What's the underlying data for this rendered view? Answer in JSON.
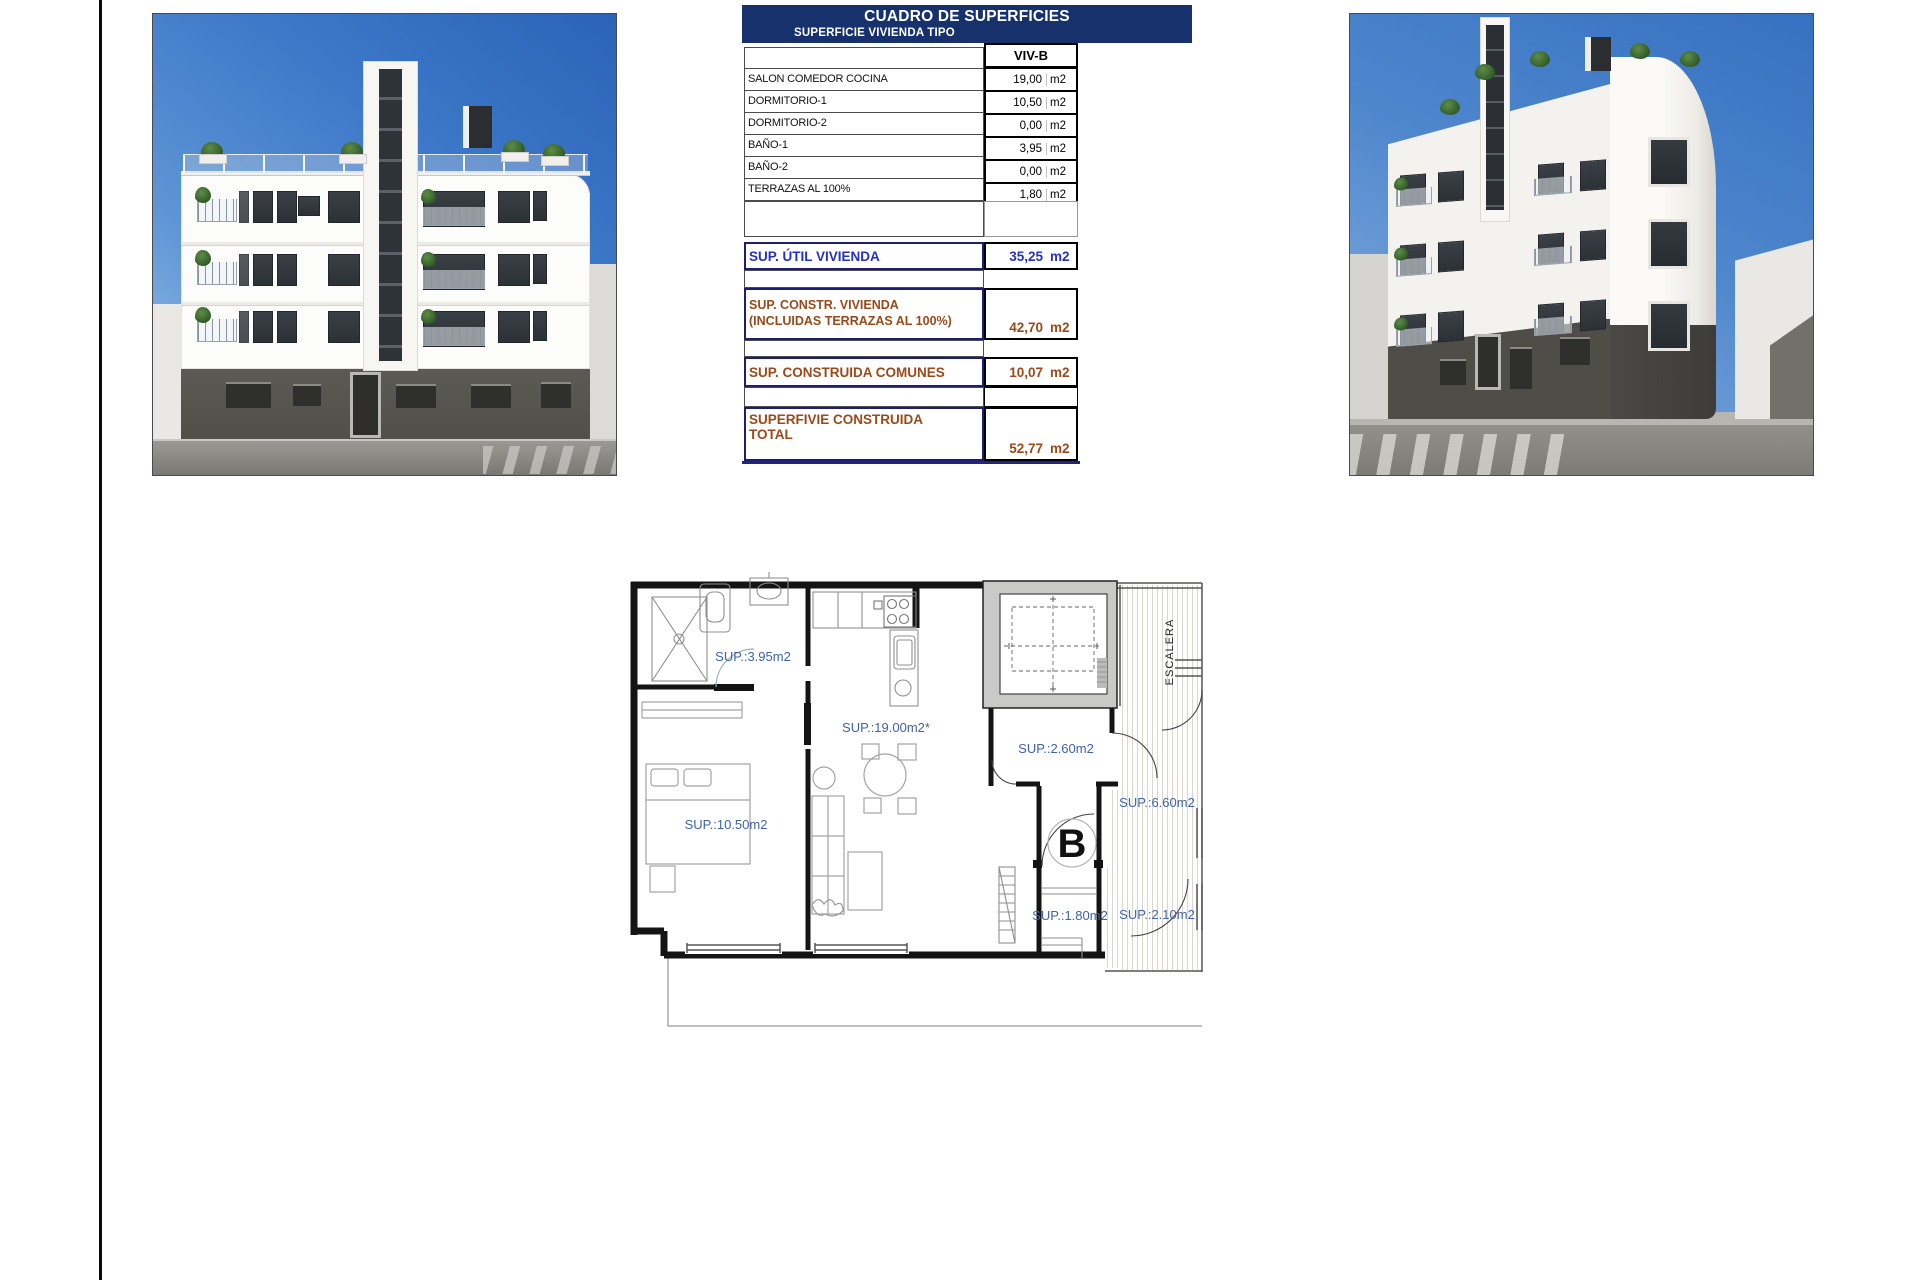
{
  "table": {
    "title": "CUADRO DE SUPERFICIES",
    "subtitle": "SUPERFICIE VIVIENDA TIPO",
    "unit_header": "VIV-B",
    "rows": [
      {
        "label": "SALON COMEDOR COCINA",
        "value": "19,00",
        "unit": "m2"
      },
      {
        "label": "DORMITORIO-1",
        "value": "10,50",
        "unit": "m2"
      },
      {
        "label": "DORMITORIO-2",
        "value": "0,00",
        "unit": "m2"
      },
      {
        "label": "BAÑO-1",
        "value": "3,95",
        "unit": "m2"
      },
      {
        "label": "BAÑO-2",
        "value": "0,00",
        "unit": "m2"
      },
      {
        "label": "TERRAZAS AL 100%",
        "value": "1,80",
        "unit": "m2"
      }
    ],
    "summary": [
      {
        "label": "SUP. ÚTIL VIVIENDA",
        "label2": "",
        "value": "35,25",
        "unit": "m2"
      },
      {
        "label": "SUP. CONSTR. VIVIENDA",
        "label2": "(INCLUIDAS TERRAZAS AL 100%)",
        "value": "42,70",
        "unit": "m2"
      },
      {
        "label": "SUP. CONSTRUIDA COMUNES",
        "label2": "",
        "value": "10,07",
        "unit": "m2"
      },
      {
        "label": "SUPERFIVIE CONSTRUIDA",
        "label2": "TOTAL",
        "value": "52,77",
        "unit": "m2"
      }
    ]
  },
  "floorplan": {
    "labels": {
      "bath": "SUP.:3.95m2",
      "living": "SUP.:19.00m2*",
      "bedroom": "SUP.:10.50m2",
      "hall": "SUP.:2.60m2",
      "landing": "SUP.:6.60m2",
      "terrace": "SUP.:1.80m2",
      "landing2": "SUP.:2.10m2",
      "stairs": "ESCALERA",
      "unit_letter": "B"
    }
  },
  "colors": {
    "header_navy": "#16316b",
    "summary_blue": "#2431c4",
    "summary_brown": "#9a4a1a",
    "plan_label_blue": "#3f63a8"
  }
}
